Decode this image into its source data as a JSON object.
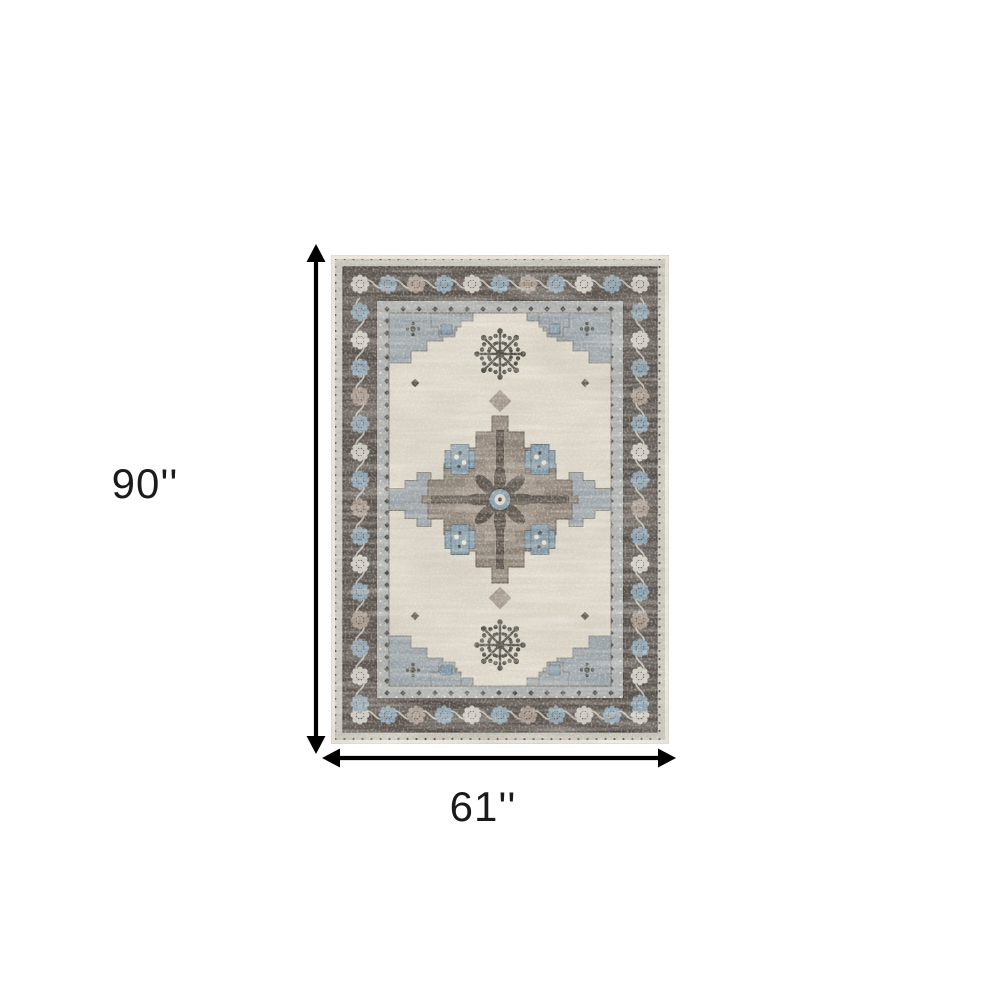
{
  "diagram": {
    "alt": "Distressed grey and blue oriental medallion area rug shown with dimension arrows",
    "height_label": "90''",
    "width_label": "61''"
  },
  "colors": {
    "background": "#ffffff",
    "dimension_arrow": "#000000",
    "dimension_text": "#1a1a1a",
    "rug_selvage_cream": "#eae4d9",
    "rug_outer_guard": "#c6c3bb",
    "rug_border_charcoal": "#57504a",
    "rug_inner_guard_grey": "#a9adac",
    "rug_field_ivory": "#dcd6c8",
    "rug_spandrel_grey_blue": "#98a1a7",
    "rug_medallion_taupe": "#8a7f73",
    "rug_accent_blue": "#7e97a6",
    "rug_motif_dark_olive": "#4b4b43",
    "rug_rosette_light": "#ccc9c0",
    "rug_rosette_taupe": "#a5968a"
  }
}
